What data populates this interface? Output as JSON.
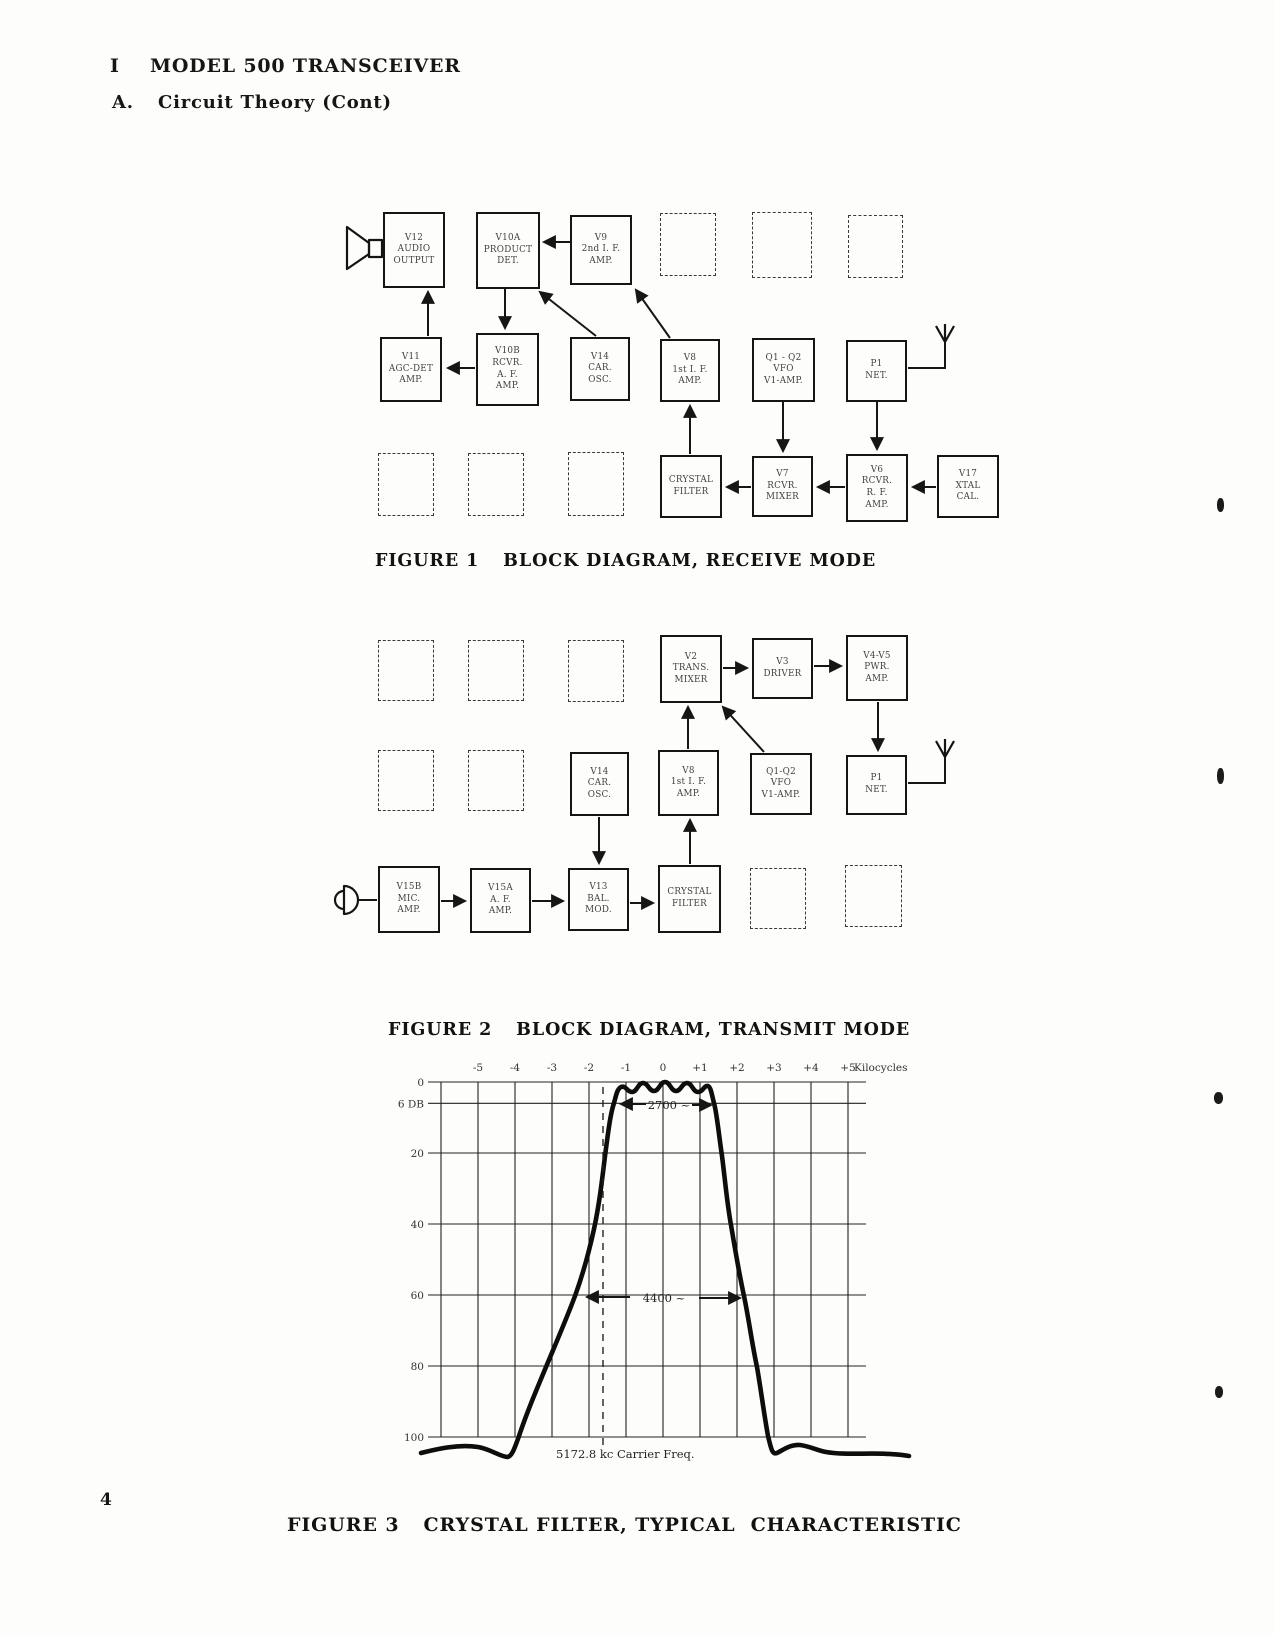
{
  "page": {
    "section_number": "I",
    "section_title": "MODEL 500 TRANSCEIVER",
    "subsection_number": "A.",
    "subsection_title": "Circuit Theory (Cont)",
    "page_number": "4"
  },
  "figure1": {
    "caption_label": "FIGURE 1",
    "caption_text": "BLOCK DIAGRAM, RECEIVE MODE",
    "blocks": [
      {
        "id": "v12",
        "lines": [
          "V12",
          "AUDIO",
          "OUTPUT"
        ]
      },
      {
        "id": "v10a",
        "lines": [
          "V10A",
          "PRODUCT",
          "DET."
        ]
      },
      {
        "id": "v9",
        "lines": [
          "V9",
          "2nd I. F.",
          "AMP."
        ]
      },
      {
        "id": "v11",
        "lines": [
          "V11",
          "AGC-DET",
          "AMP."
        ]
      },
      {
        "id": "v10b",
        "lines": [
          "V10B",
          "RCVR.",
          "A. F.",
          "AMP."
        ]
      },
      {
        "id": "v14",
        "lines": [
          "V14",
          "CAR.",
          "OSC."
        ]
      },
      {
        "id": "v8",
        "lines": [
          "V8",
          "1st I. F.",
          "AMP."
        ]
      },
      {
        "id": "q1q2",
        "lines": [
          "Q1 - Q2",
          "VFO",
          "V1-AMP."
        ]
      },
      {
        "id": "p1",
        "lines": [
          "P1",
          "NET."
        ]
      },
      {
        "id": "xf",
        "lines": [
          "CRYSTAL",
          "FILTER"
        ]
      },
      {
        "id": "v7",
        "lines": [
          "V7",
          "RCVR.",
          "MIXER"
        ]
      },
      {
        "id": "v6",
        "lines": [
          "V6",
          "RCVR.",
          "R. F.",
          "AMP."
        ]
      },
      {
        "id": "v17",
        "lines": [
          "V17",
          "XTAL",
          "CAL."
        ]
      }
    ]
  },
  "figure2": {
    "caption_label": "FIGURE 2",
    "caption_text": "BLOCK DIAGRAM, TRANSMIT MODE",
    "blocks": [
      {
        "id": "v2",
        "lines": [
          "V2",
          "TRANS.",
          "MIXER"
        ]
      },
      {
        "id": "v3",
        "lines": [
          "V3",
          "DRIVER"
        ]
      },
      {
        "id": "v4v5",
        "lines": [
          "V4-V5",
          "PWR.",
          "AMP."
        ]
      },
      {
        "id": "v14",
        "lines": [
          "V14",
          "CAR.",
          "OSC."
        ]
      },
      {
        "id": "v8",
        "lines": [
          "V8",
          "1st I. F.",
          "AMP."
        ]
      },
      {
        "id": "q1q2",
        "lines": [
          "Q1-Q2",
          "VFO",
          "V1-AMP."
        ]
      },
      {
        "id": "p1",
        "lines": [
          "P1",
          "NET."
        ]
      },
      {
        "id": "v15b",
        "lines": [
          "V15B",
          "MIC.",
          "AMP."
        ]
      },
      {
        "id": "v15a",
        "lines": [
          "V15A",
          "A. F.",
          "AMP."
        ]
      },
      {
        "id": "v13",
        "lines": [
          "V13",
          "BAL.",
          "MOD."
        ]
      },
      {
        "id": "xf",
        "lines": [
          "CRYSTAL",
          "FILTER"
        ]
      }
    ]
  },
  "figure3": {
    "caption_label": "FIGURE 3",
    "caption_text": "CRYSTAL FILTER, TYPICAL  CHARACTERISTIC",
    "chart_data": {
      "type": "line",
      "title": "Crystal filter selectivity curve (attenuation vs. frequency offset)",
      "xlabel_unit": "Kilocycles",
      "ylabel_unit": "DB attenuation",
      "x_tick_labels": [
        "-5",
        "-4",
        "-3",
        "-2",
        "-1",
        "0",
        "+1",
        "+2",
        "+3",
        "+4",
        "+5"
      ],
      "x_unit_label": "Kilocycles",
      "y_tick_labels": [
        "0",
        "6 DB",
        "20",
        "40",
        "60",
        "80",
        "100"
      ],
      "y_values_db": [
        0,
        6,
        20,
        40,
        60,
        80,
        100
      ],
      "xlim_kc": [
        -6,
        5.5
      ],
      "ylim_db": [
        0,
        100
      ],
      "grid": true,
      "annotations": {
        "bandwidth_6db": "2700 ~",
        "bandwidth_60db": "4400 ~",
        "carrier": "5172.8 kc Carrier Freq."
      },
      "points_kc_db": [
        [
          -6.5,
          104
        ],
        [
          -5.0,
          103
        ],
        [
          -4.3,
          106
        ],
        [
          -3.9,
          100
        ],
        [
          -3.2,
          80
        ],
        [
          -2.4,
          60
        ],
        [
          -1.9,
          41
        ],
        [
          -1.6,
          20
        ],
        [
          -1.35,
          6
        ],
        [
          -1.2,
          0
        ],
        [
          0,
          0
        ],
        [
          1.2,
          0
        ],
        [
          1.35,
          6
        ],
        [
          1.6,
          20
        ],
        [
          1.85,
          40
        ],
        [
          2.2,
          60
        ],
        [
          2.5,
          80
        ],
        [
          2.85,
          100
        ],
        [
          3.7,
          102
        ],
        [
          6.7,
          105
        ]
      ]
    }
  }
}
